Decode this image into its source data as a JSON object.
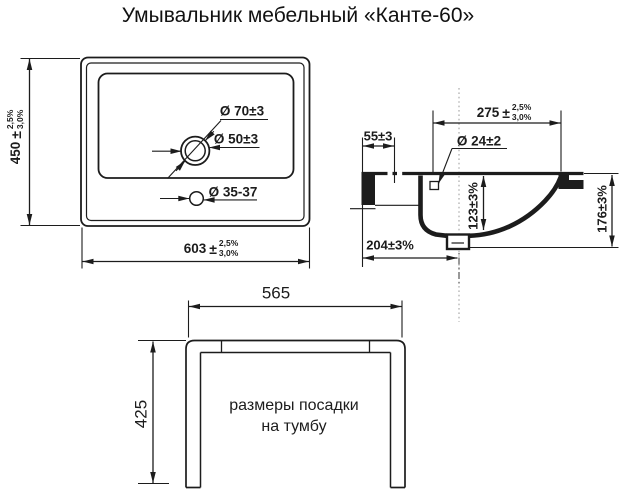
{
  "title": "Умывальник мебельный «Канте-60»",
  "front_view": {
    "height_dim": {
      "value": "450",
      "pm": "±",
      "tol_upper": "2,5%",
      "tol_lower": "3,0%"
    },
    "width_dim": {
      "value": "603",
      "pm": "±",
      "tol_upper": "2,5%",
      "tol_lower": "3,0%"
    },
    "overflow_outer_dia": "Ø 70±3",
    "overflow_inner_dia": "Ø 50±3",
    "faucet_hole_dia": "Ø 35-37"
  },
  "side_view": {
    "front_depth_dim": {
      "value": "275",
      "pm": "±",
      "tol_upper": "2,5%",
      "tol_lower": "3,0%"
    },
    "back_ledge_dim": "55±3",
    "overflow_hole_dia": "Ø 24±2",
    "bowl_depth_dim": "123±3%",
    "total_height_dim": "176±3%",
    "drain_offset_dim": "204±3%"
  },
  "mount_view": {
    "width_dim": "565",
    "depth_dim": "425",
    "note_line1": "размеры посадки",
    "note_line2": "на тумбу"
  },
  "colors": {
    "line": "#1c1c1c",
    "background": "#ffffff"
  }
}
